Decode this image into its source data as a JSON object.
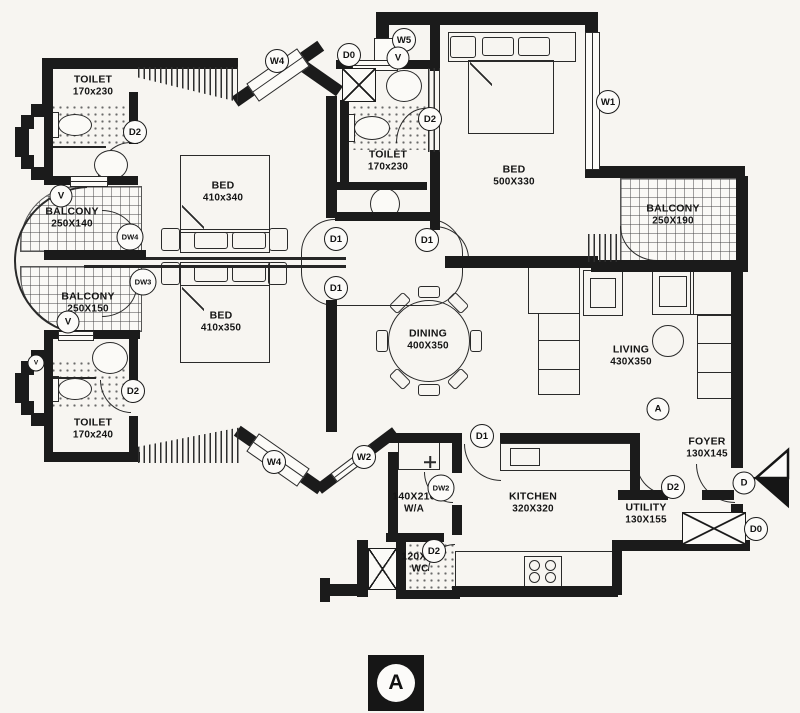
{
  "plan": {
    "markers": {
      "section": "A",
      "entry_door": "D"
    },
    "rooms": [
      {
        "line1": "TOILET",
        "line2": "170x230",
        "x": 93,
        "y": 86
      },
      {
        "line1": "BALCONY",
        "line2": "250X140",
        "x": 72,
        "y": 218
      },
      {
        "line1": "BALCONY",
        "line2": "250X150",
        "x": 88,
        "y": 303
      },
      {
        "line1": "TOILET",
        "line2": "170x240",
        "x": 93,
        "y": 429
      },
      {
        "line1": "BED",
        "line2": "410x340",
        "x": 223,
        "y": 192
      },
      {
        "line1": "BED",
        "line2": "410x350",
        "x": 221,
        "y": 322
      },
      {
        "line1": "TOILET",
        "line2": "170x230",
        "x": 388,
        "y": 161
      },
      {
        "line1": "BED",
        "line2": "500X330",
        "x": 514,
        "y": 176
      },
      {
        "line1": "BALCONY",
        "line2": "250X190",
        "x": 673,
        "y": 215
      },
      {
        "line1": "DINING",
        "line2": "400X350",
        "x": 428,
        "y": 340
      },
      {
        "line1": "LIVING",
        "line2": "430X350",
        "x": 631,
        "y": 356
      },
      {
        "line1": "FOYER",
        "line2": "130X145",
        "x": 707,
        "y": 448
      },
      {
        "line1": "KITCHEN",
        "line2": "320X320",
        "x": 533,
        "y": 503
      },
      {
        "line1": "UTILITY",
        "line2": "130X155",
        "x": 646,
        "y": 514
      },
      {
        "line1": "140X210",
        "line2": "W/A",
        "x": 414,
        "y": 503
      },
      {
        "line1": "120X90",
        "line2": "WC",
        "x": 420,
        "y": 563
      }
    ],
    "tags": [
      {
        "label": "D2",
        "x": 135,
        "y": 132
      },
      {
        "label": "V",
        "x": 61,
        "y": 196
      },
      {
        "label": "DW4",
        "x": 130,
        "y": 237
      },
      {
        "label": "DW3",
        "x": 143,
        "y": 282
      },
      {
        "label": "V",
        "x": 68,
        "y": 322
      },
      {
        "label": "V",
        "x": 36,
        "y": 363,
        "small": true
      },
      {
        "label": "D2",
        "x": 133,
        "y": 391
      },
      {
        "label": "W4",
        "x": 277,
        "y": 61
      },
      {
        "label": "D0",
        "x": 349,
        "y": 55
      },
      {
        "label": "W5",
        "x": 404,
        "y": 40
      },
      {
        "label": "V",
        "x": 398,
        "y": 58
      },
      {
        "label": "D2",
        "x": 430,
        "y": 119
      },
      {
        "label": "W1",
        "x": 608,
        "y": 102
      },
      {
        "label": "D1",
        "x": 336,
        "y": 239
      },
      {
        "label": "D1",
        "x": 427,
        "y": 240
      },
      {
        "label": "D1",
        "x": 336,
        "y": 288
      },
      {
        "label": "D1",
        "x": 482,
        "y": 436
      },
      {
        "label": "W2",
        "x": 364,
        "y": 457
      },
      {
        "label": "W4",
        "x": 274,
        "y": 462
      },
      {
        "label": "DW2",
        "x": 441,
        "y": 488
      },
      {
        "label": "D2",
        "x": 434,
        "y": 551
      },
      {
        "label": "D2",
        "x": 673,
        "y": 487
      },
      {
        "label": "D",
        "x": 744,
        "y": 483
      },
      {
        "label": "D0",
        "x": 756,
        "y": 529
      },
      {
        "label": "A",
        "x": 658,
        "y": 409
      }
    ]
  }
}
